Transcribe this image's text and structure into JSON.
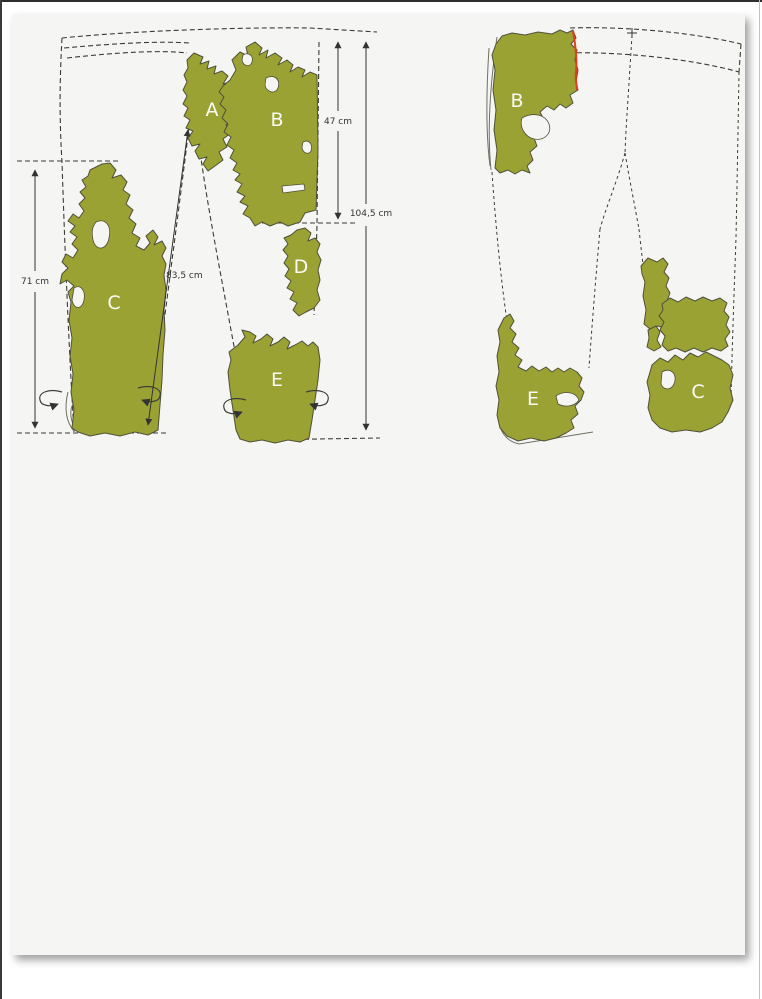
{
  "page": {
    "background": "#ffffff",
    "card_color": "#f5f5f4"
  },
  "colors": {
    "fragment_fill": "#99a233",
    "fragment_outline": "#50503a",
    "outline_line": "#3b3b35",
    "measure_line": "#333333",
    "measure_text": "#333333",
    "label_text": "#fafaf7",
    "highlight_red": "#e63c1e"
  },
  "front_view": {
    "fragments": [
      {
        "label": "A"
      },
      {
        "label": "B"
      },
      {
        "label": "C"
      },
      {
        "label": "D"
      },
      {
        "label": "E"
      }
    ],
    "measurements": [
      {
        "label": "47 cm"
      },
      {
        "label": "104,5 cm"
      },
      {
        "label": "71 cm"
      },
      {
        "label": "83,5 cm"
      }
    ]
  },
  "back_view": {
    "fragments": [
      {
        "label": "B"
      },
      {
        "label": "E"
      },
      {
        "label": "C"
      }
    ]
  }
}
